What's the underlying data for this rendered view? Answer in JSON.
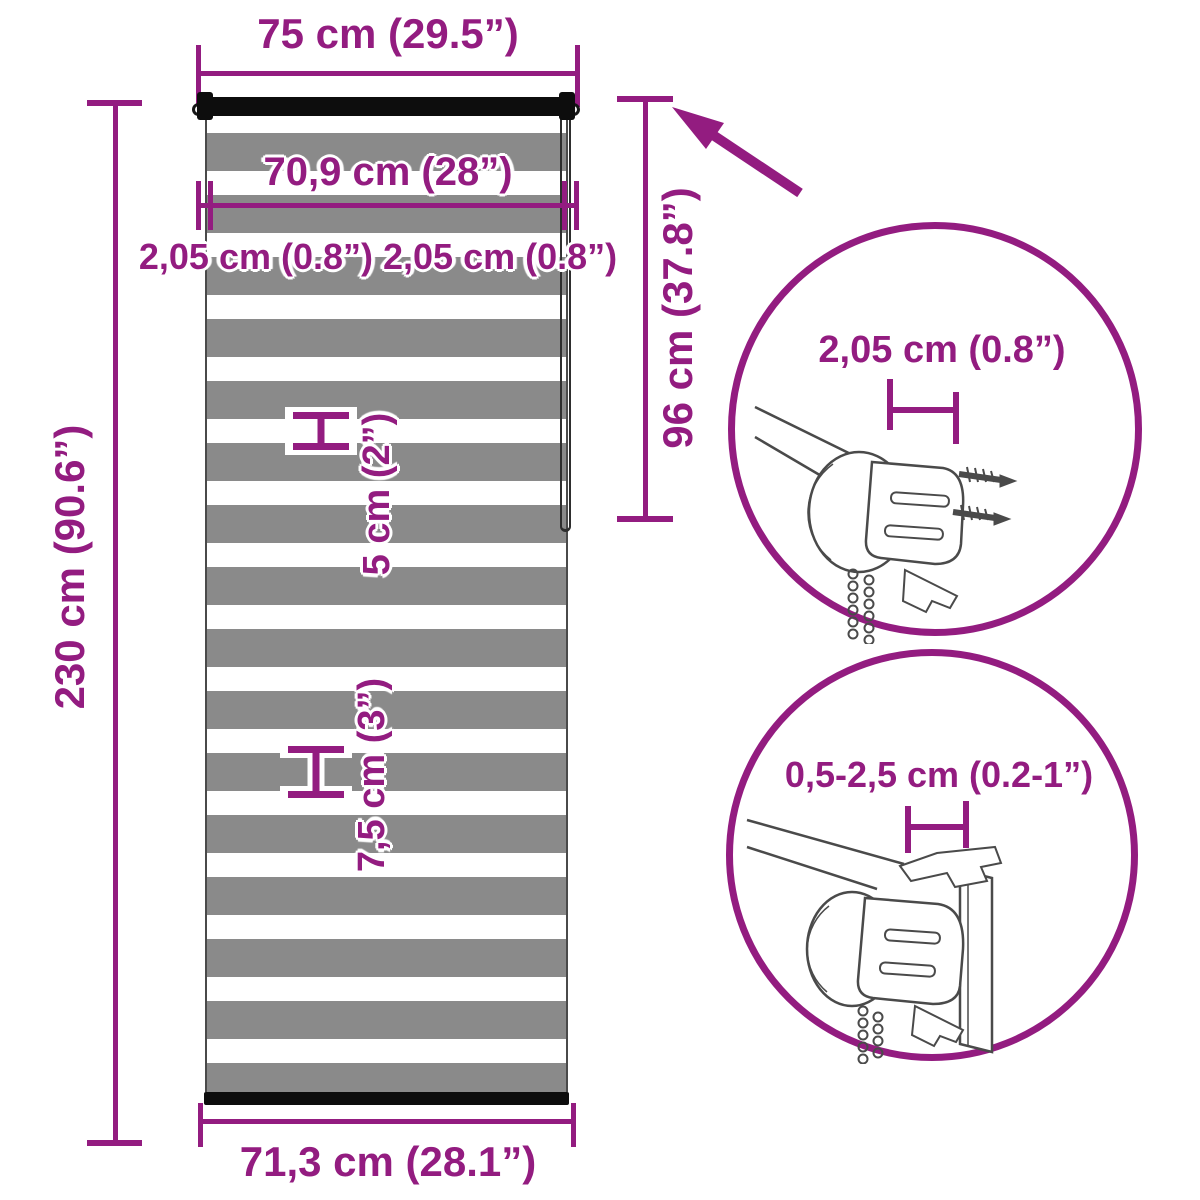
{
  "colors": {
    "accent": "#931C80",
    "stripe_gray": "#8a8a8a",
    "bar_black": "#0d0d0d",
    "line_art": "#4a4a4a"
  },
  "dimensions": {
    "top_width": "75 cm (29.5”)",
    "fabric_width": "70,9 cm (28”)",
    "side_offsets": "2,05 cm (0.8”) 2,05 cm (0.8”)",
    "total_height": "230 cm (90.6”)",
    "roll_height": "96 cm (37.8”)",
    "sheer_stripe": "5 cm (2”)",
    "fabric_stripe": "7,5 cm (3”)",
    "bottom_width": "71,3 cm (28.1”)"
  },
  "details": {
    "top_circle_label": "2,05 cm (0.8”)",
    "bottom_circle_label": "0,5-2,5 cm (0.2-1”)"
  }
}
